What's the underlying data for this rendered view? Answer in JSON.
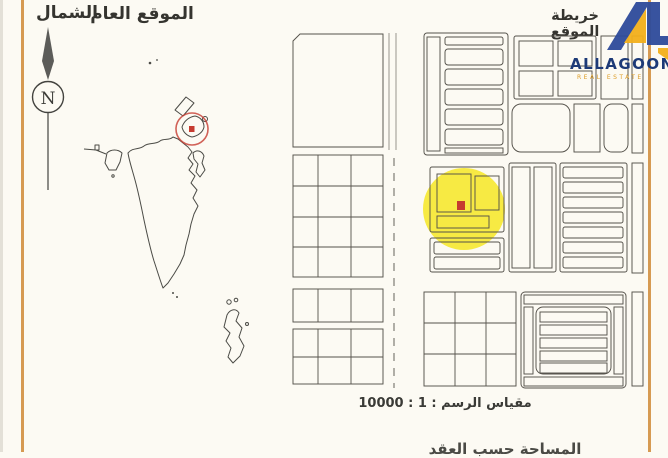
{
  "document": {
    "north_label": "الشمال",
    "general_location_title": "الموقع العام",
    "site_map_title": "خريطة الموقع",
    "compass_letter": "N",
    "scale_label": "مقياس الرسم : 1 : 10000",
    "footer_partial_text": "المساحة حسب العقد"
  },
  "logo": {
    "name": "ALLAGOON",
    "tagline": "REAL ESTATE"
  },
  "colors": {
    "paper": "#fcfaf3",
    "border_orange": "#d69a52",
    "plan_line": "#55524b",
    "map_outline": "#4b4b46",
    "highlight_yellow": "#f5e616",
    "marker_red": "#c63b30",
    "logo_blue": "#2e4b9b",
    "logo_yellow": "#f3b01c"
  }
}
